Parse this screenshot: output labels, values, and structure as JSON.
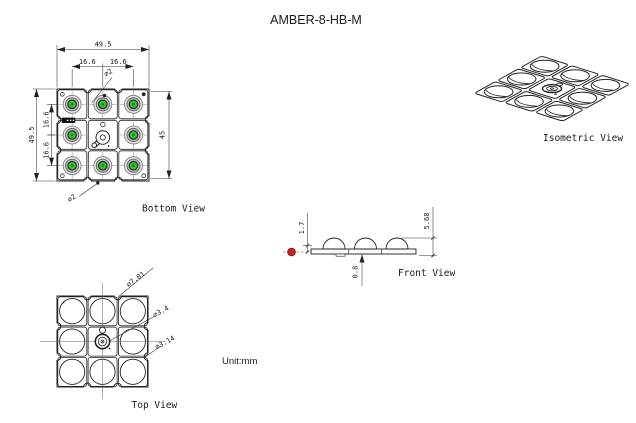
{
  "title": "AMBER-8-HB-M",
  "unit_label": "Unit:mm",
  "bottom_view": {
    "label": "Bottom View",
    "dim_width": "49.5",
    "dim_pitch_h1": "16.6",
    "dim_pitch_h2": "16.6",
    "dim_height": "49.5",
    "dim_pitch_v1": "16.6",
    "dim_pitch_v2": "16.6",
    "dim_span": "45",
    "dim_hole_top": "⌀2",
    "dim_hole_bottom": "⌀2"
  },
  "top_view": {
    "label": "Top View",
    "dim_lens": "⌀7.01",
    "dim_center": "⌀3.4",
    "dim_notch": "⌀3.14"
  },
  "front_view": {
    "label": "Front View",
    "dim_lens_height": "1.7",
    "dim_total_height": "5.68",
    "dim_base_thickness": "0.8"
  },
  "isometric_view": {
    "label": "Isometric View"
  },
  "colors": {
    "led_green": "#35c72b",
    "led_green_dark": "#0f9410",
    "marker_red": "#c62828",
    "line": "#222222"
  }
}
